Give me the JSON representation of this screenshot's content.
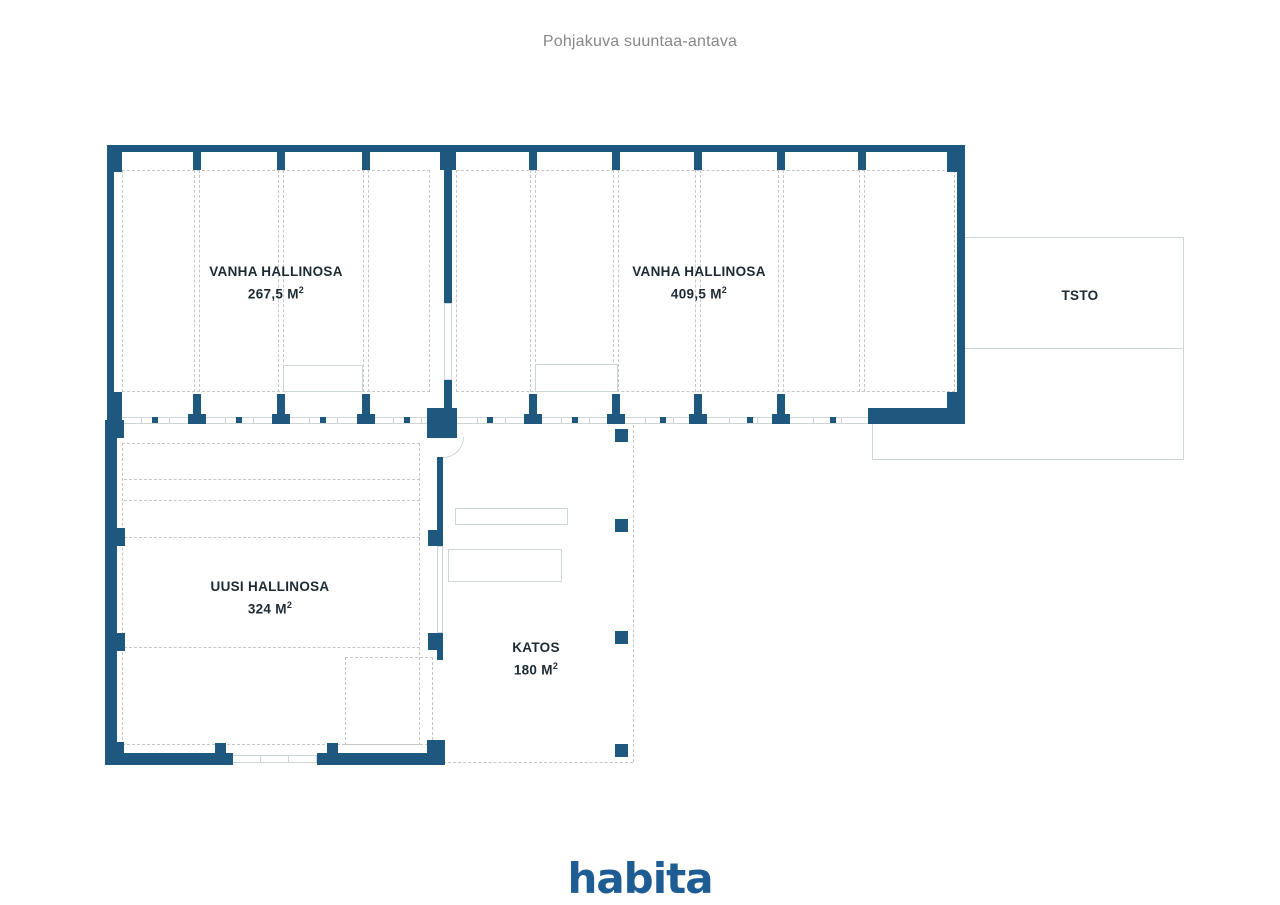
{
  "title": "Pohjakuva suuntaa-antava",
  "brand": {
    "logo_text": "habita"
  },
  "colors": {
    "wall": "#1f587e",
    "dashed_grid": "#c6c6c6",
    "light_line": "#ccd5d8",
    "label_text": "#1d2a33",
    "title_text": "#878787",
    "logo": "#1e5c94"
  },
  "rooms": [
    {
      "id": "vanha-hallinosa-1",
      "name": "VANHA HALLINOSA",
      "area": "267,5 M",
      "area_sup": "2"
    },
    {
      "id": "vanha-hallinosa-2",
      "name": "VANHA HALLINOSA",
      "area": "409,5 M",
      "area_sup": "2"
    },
    {
      "id": "tsto",
      "name": "TSTO"
    },
    {
      "id": "uusi-hallinosa",
      "name": "UUSI HALLINOSA",
      "area": "324 M",
      "area_sup": "2"
    },
    {
      "id": "katos",
      "name": "KATOS",
      "area": "180 M",
      "area_sup": "2"
    }
  ]
}
